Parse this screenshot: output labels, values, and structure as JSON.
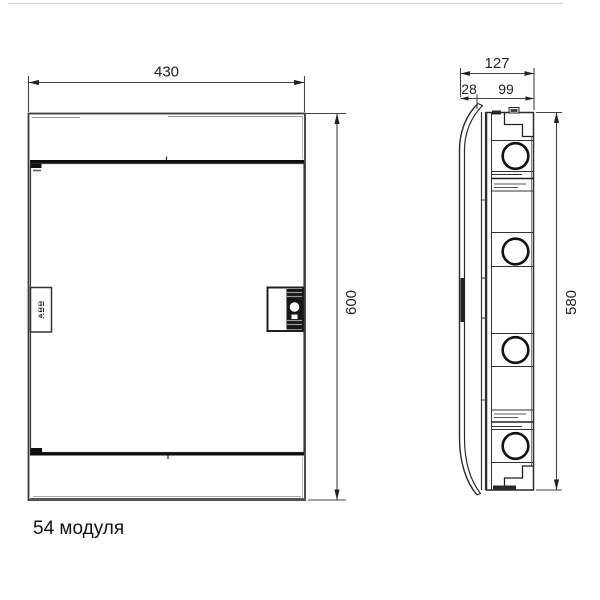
{
  "caption": "54 модуля",
  "front_view": {
    "width_dim": "430",
    "height_dim": "600",
    "brand": "ABB"
  },
  "side_view": {
    "total_depth_dim": "127",
    "door_depth_dim": "28",
    "box_depth_dim": "99",
    "height_dim": "580"
  }
}
